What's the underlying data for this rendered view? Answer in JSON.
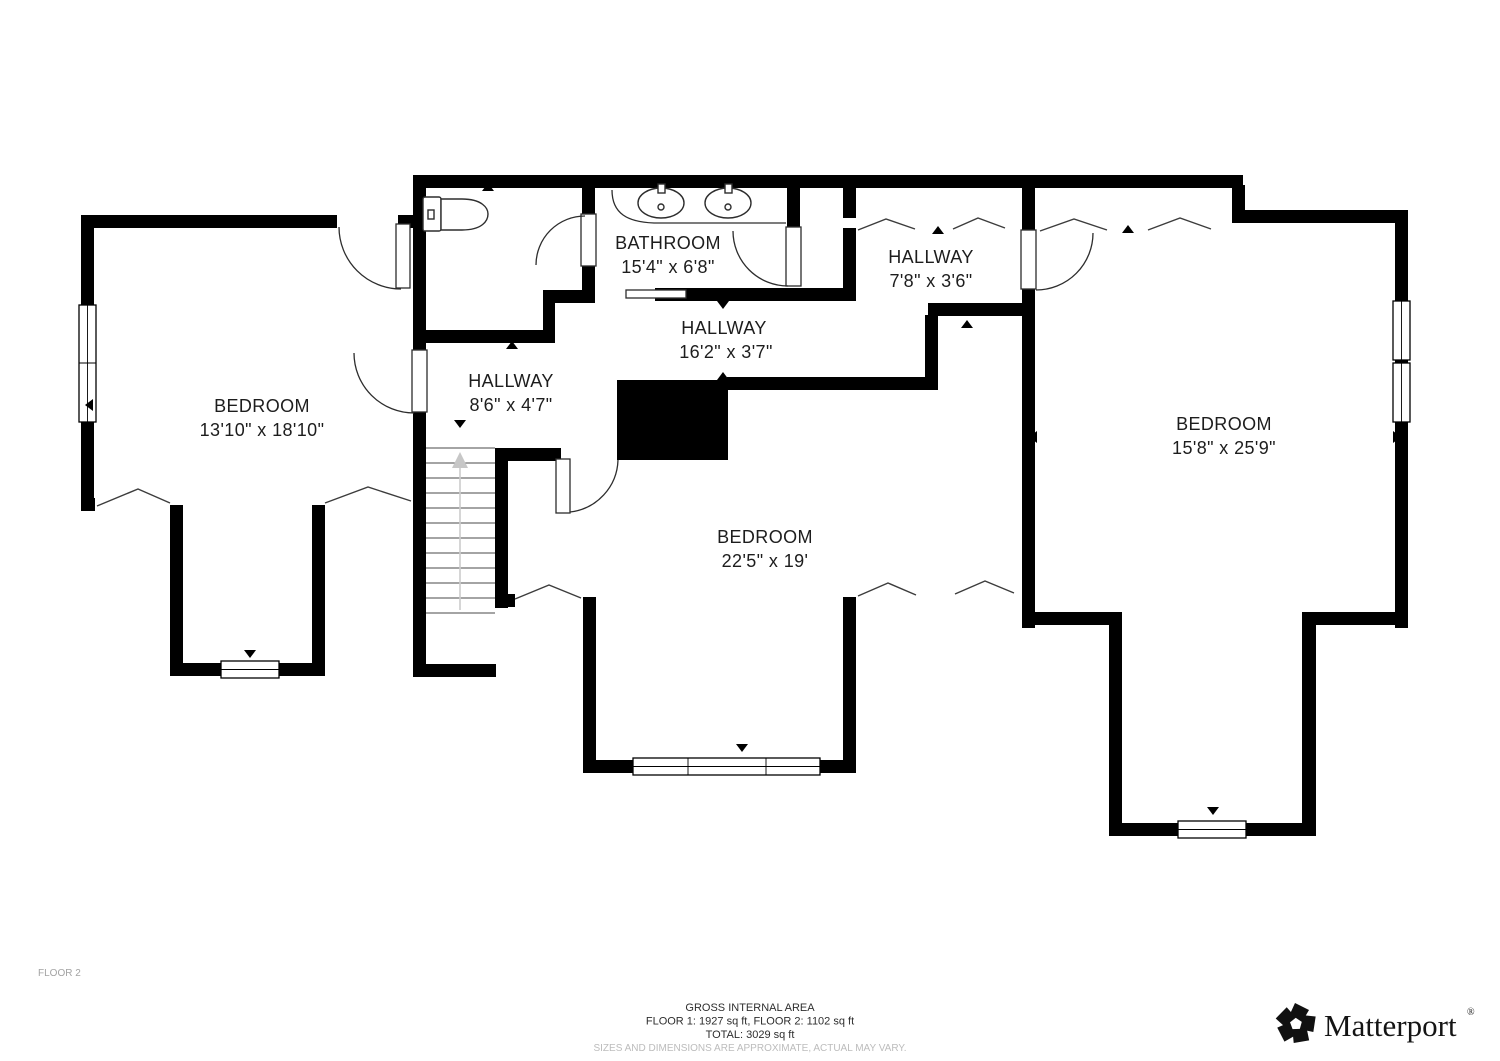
{
  "floor_plan": {
    "floor_label": "FLOOR 2",
    "rooms": [
      {
        "name": "BATHROOM",
        "dimensions": "15'4\" x 6'8\""
      },
      {
        "name": "HALLWAY",
        "dimensions": "7'8\" x 3'6\""
      },
      {
        "name": "HALLWAY",
        "dimensions": "16'2\" x 3'7\""
      },
      {
        "name": "HALLWAY",
        "dimensions": "8'6\" x 4'7\""
      },
      {
        "name": "BEDROOM",
        "dimensions": "13'10\" x 18'10\""
      },
      {
        "name": "BEDROOM",
        "dimensions": "22'5\" x 19'"
      },
      {
        "name": "BEDROOM",
        "dimensions": "15'8\" x 25'9\""
      }
    ],
    "fixtures": [
      "toilet-icon",
      "sink-icon",
      "sink-icon",
      "staircase-up"
    ],
    "colors": {
      "wall": "#000000",
      "background": "#ffffff",
      "label": "#1d1d1d",
      "muted": "#a3a3a3",
      "disclaimer": "#bcbcbc"
    }
  },
  "footer": {
    "area_title": "GROSS INTERNAL AREA",
    "area_line1": "FLOOR 1: 1927 sq ft, FLOOR 2: 1102 sq ft",
    "area_line2": "TOTAL: 3029 sq ft",
    "disclaimer": "SIZES AND DIMENSIONS ARE APPROXIMATE, ACTUAL MAY VARY."
  },
  "branding": {
    "logo_icon": "matterport-pinwheel-icon",
    "logo_text": "Matterport",
    "registered_mark": "®"
  }
}
